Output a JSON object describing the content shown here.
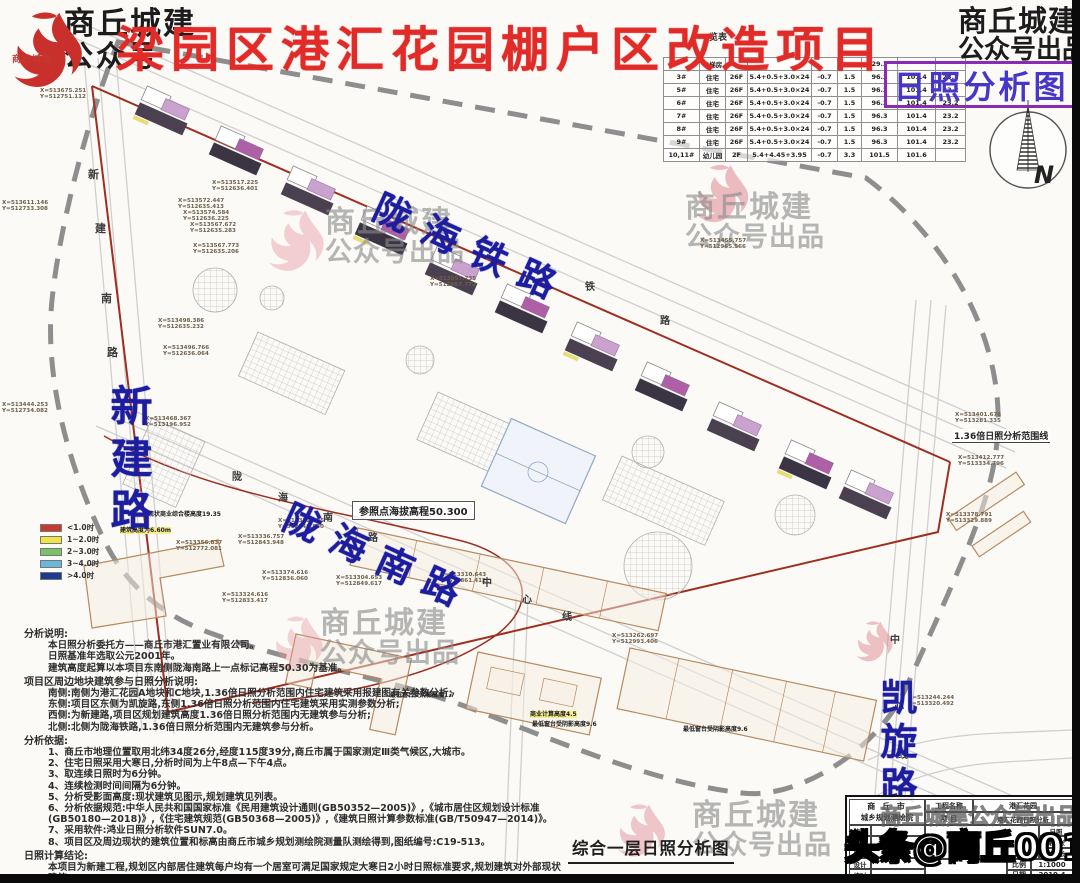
{
  "branding": {
    "top_left": {
      "line1": "商丘城建",
      "line2": "公众号",
      "seal_text": "商丘城建"
    },
    "top_right": {
      "line1": "商丘城建",
      "line2": "公众号出品"
    },
    "watermark": {
      "line1": "商丘城建",
      "line2": "公众号出品"
    },
    "watermark_full": "商丘城建公众号出品",
    "bottom_overlay": "头条@商丘001"
  },
  "header": {
    "title": "梁园区港汇花园棚户区改造项目",
    "subtitle": "日照分析图",
    "title_color": "#e12b28",
    "subtitle_color": "#4637c9",
    "subtitle_border_color": "#8a2bb5"
  },
  "building_table": {
    "title_fragment": "一览表",
    "header_visible": [
      "",
      "电梯房",
      "",
      "",
      "",
      "",
      "29.3",
      "",
      ""
    ],
    "rows": [
      [
        "3#",
        "住宅",
        "26F",
        "5.4+0.5+3.0×24",
        "-0.7",
        "1.5",
        "96.3",
        "101.4",
        "23.2"
      ],
      [
        "5#",
        "住宅",
        "26F",
        "5.4+0.5+3.0×24",
        "-0.7",
        "1.5",
        "96.3",
        "101.4",
        "23.2"
      ],
      [
        "6#",
        "住宅",
        "26F",
        "5.4+0.5+3.0×24",
        "-0.7",
        "1.5",
        "96.3",
        "101.4",
        "23.2"
      ],
      [
        "7#",
        "住宅",
        "26F",
        "5.4+0.5+3.0×24",
        "-0.7",
        "1.5",
        "96.3",
        "101.4",
        "23.2"
      ],
      [
        "8#",
        "住宅",
        "26F",
        "5.4+0.5+3.0×24",
        "-0.7",
        "1.5",
        "96.3",
        "101.4",
        "23.2"
      ],
      [
        "9#",
        "住宅",
        "26F",
        "5.4+0.5+3.0×24",
        "-0.7",
        "1.5",
        "96.3",
        "101.4",
        "23.2"
      ],
      [
        "10,11#",
        "幼儿园",
        "2F",
        "5.4+4.45+3.95",
        "-0.7",
        "3.3",
        "101.5",
        "101.6",
        ""
      ]
    ]
  },
  "legend": {
    "items": [
      {
        "color": "#c43b30",
        "label": "<1.0时"
      },
      {
        "color": "#efe34a",
        "label": "1~2.0时"
      },
      {
        "color": "#7cc06a",
        "label": "2~3.0时"
      },
      {
        "color": "#69b7d9",
        "label": "3~4.0时"
      },
      {
        "color": "#1d3c8f",
        "label": ">4.0时"
      }
    ]
  },
  "map": {
    "north": "N",
    "labels": {
      "railway": "陇海铁路",
      "south_road": "陇海南路",
      "west_road": "新建路",
      "east_road": "凯旋路",
      "reference": "参照点海拔高程50.300",
      "range": "1.36倍日照分析范围线"
    },
    "road_chars": [
      {
        "ch": "新",
        "x": 88,
        "y": 166,
        "s": 11
      },
      {
        "ch": "建",
        "x": 95,
        "y": 220,
        "s": 11
      },
      {
        "ch": "南",
        "x": 101,
        "y": 290,
        "s": 11
      },
      {
        "ch": "路",
        "x": 107,
        "y": 344,
        "s": 11
      },
      {
        "ch": "陇",
        "x": 232,
        "y": 468,
        "s": 10
      },
      {
        "ch": "海",
        "x": 278,
        "y": 489,
        "s": 10
      },
      {
        "ch": "南",
        "x": 323,
        "y": 509,
        "s": 10
      },
      {
        "ch": "路",
        "x": 368,
        "y": 529,
        "s": 10
      },
      {
        "ch": "中",
        "x": 482,
        "y": 574,
        "s": 10
      },
      {
        "ch": "心",
        "x": 522,
        "y": 591,
        "s": 10
      },
      {
        "ch": "线",
        "x": 562,
        "y": 608,
        "s": 10
      },
      {
        "ch": "铁",
        "x": 585,
        "y": 278,
        "s": 10
      },
      {
        "ch": "路",
        "x": 660,
        "y": 312,
        "s": 10
      },
      {
        "ch": "中",
        "x": 890,
        "y": 631,
        "s": 10
      },
      {
        "ch": "心",
        "x": 894,
        "y": 698,
        "s": 10
      },
      {
        "ch": "线",
        "x": 898,
        "y": 746,
        "s": 10
      }
    ],
    "coord_labels": [
      {
        "x": 40,
        "y": 88,
        "a": "X=513675.251",
        "b": "Y=512751.112"
      },
      {
        "x": 2,
        "y": 200,
        "a": "X=513611.146",
        "b": "Y=512733.308"
      },
      {
        "x": 2,
        "y": 402,
        "a": "X=513444.253",
        "b": "Y=512734.082"
      },
      {
        "x": 212,
        "y": 180,
        "a": "X=513517.225",
        "b": "Y=512636.401"
      },
      {
        "x": 178,
        "y": 198,
        "a": "X=513572.447",
        "b": "Y=512635.413"
      },
      {
        "x": 183,
        "y": 210,
        "a": "X=513574.584",
        "b": "Y=512636.225"
      },
      {
        "x": 190,
        "y": 222,
        "a": "X=513567.672",
        "b": "Y=512635.283"
      },
      {
        "x": 193,
        "y": 243,
        "a": "X=513567.773",
        "b": "Y=512635.206"
      },
      {
        "x": 158,
        "y": 318,
        "a": "X=513498.386",
        "b": "Y=512635.232"
      },
      {
        "x": 163,
        "y": 345,
        "a": "X=513496.766",
        "b": "Y=512636.064"
      },
      {
        "x": 145,
        "y": 416,
        "a": "X=513468.367",
        "b": "Y=513196.952"
      },
      {
        "x": 278,
        "y": 518,
        "a": "X=513372.225",
        "b": "Y=512849.880"
      },
      {
        "x": 176,
        "y": 540,
        "a": "X=513356.837",
        "b": "Y=512772.081"
      },
      {
        "x": 238,
        "y": 534,
        "a": "X=513336.757",
        "b": "Y=512843.948"
      },
      {
        "x": 262,
        "y": 570,
        "a": "X=513374.616",
        "b": "Y=512836.060"
      },
      {
        "x": 222,
        "y": 592,
        "a": "X=513324.616",
        "b": "Y=512833.417"
      },
      {
        "x": 336,
        "y": 575,
        "a": "X=513304.653",
        "b": "Y=512849.617"
      },
      {
        "x": 440,
        "y": 572,
        "a": "X=513310.643",
        "b": "Y=512861.412"
      },
      {
        "x": 430,
        "y": 276,
        "a": "X=513057.735",
        "b": "Y=512967.772"
      },
      {
        "x": 700,
        "y": 238,
        "a": "X=513455.757",
        "b": "Y=512965.566"
      },
      {
        "x": 955,
        "y": 412,
        "a": "X=513401.676",
        "b": "Y=513281.335"
      },
      {
        "x": 958,
        "y": 455,
        "a": "X=513412.777",
        "b": "Y=513334.796"
      },
      {
        "x": 946,
        "y": 512,
        "a": "X=513378.791",
        "b": "Y=513329.889"
      },
      {
        "x": 908,
        "y": 695,
        "a": "X=513244.244",
        "b": "Y=513320.492"
      },
      {
        "x": 612,
        "y": 633,
        "a": "X=513262.697",
        "b": "Y=512993.406"
      }
    ],
    "annotations": [
      {
        "x": 120,
        "y": 527,
        "t": "建筑高度为6.60m",
        "hl": 1
      },
      {
        "x": 148,
        "y": 511,
        "t": "现状商业综合楼高度19.35",
        "hl": 0
      },
      {
        "x": 390,
        "y": 692,
        "t": "最低窗台受阴影高度1.7",
        "hl": 0
      },
      {
        "x": 530,
        "y": 711,
        "t": "商业计算高度4.5",
        "hl": 1
      },
      {
        "x": 532,
        "y": 721,
        "t": "最低窗台受阴影高度9.6",
        "hl": 0
      },
      {
        "x": 683,
        "y": 726,
        "t": "最低窗台受阴影高度9.6",
        "hl": 0
      }
    ],
    "watermarks": [
      {
        "x": 395,
        "y": 237
      },
      {
        "x": 755,
        "y": 222
      },
      {
        "x": 390,
        "y": 638
      },
      {
        "x": 762,
        "y": 830
      }
    ]
  },
  "notes": {
    "sections": [
      {
        "heading": "分析说明:",
        "lines": [
          "本日照分析委托方——商丘市港汇置业有限公司。",
          "日照基准年选取公元2001年。",
          "建筑高度起算以本项目东南侧陇海南路上一点标记高程50.30为基准。"
        ]
      },
      {
        "heading": "项目区周边地块建筑参与日照分析说明:",
        "lines": [
          "南侧:南侧为港汇花园A地块和C地块,1.36倍日照分析范围内住宅建筑采用报建图有关参数分析;",
          "东侧:项目区东侧为凯旋路,东侧1.36倍日照分析范围内住宅建筑采用实测参数分析;",
          "西侧:为新建路,项目区规划建筑高度1.36倍日照分析范围内无建筑参与分析;",
          "北侧:北侧为陇海铁路,1.36倍日照分析范围内无建筑参与分析。"
        ]
      },
      {
        "heading": "分析依据:",
        "lines": [
          "1、商丘市地理位置取用北纬34度26分,经度115度39分,商丘市属于国家测定Ⅲ类气候区,大城市。",
          "2、住宅日照采用大寒日,分析时间为上午8点—下午4点。",
          "3、取连续日照时为6分钟。",
          "4、连续检测时间间隔为6分钟。",
          "5、分析受影面高度:现状建筑见图示,规划建筑见列表。",
          "6、分析依据规范:中华人民共和国国家标准《民用建筑设计通则(GB50352—2005)》,《城市居住区规划设计标准(GB50180—2018)》,《住宅建筑规范(GB50368—2005)》,《建筑日照计算参数标准(GB/T50947—2014)》。",
          "7、采用软件:鸿业日照分析软件SUN7.0。",
          "8、项目区及周边现状的建筑位置和标高由商丘市城乡规划测绘院测量队测绘得到,图纸编号:C19-513。"
        ]
      },
      {
        "heading": "日照计算结论:",
        "lines": [
          "本项目为新建工程,规划区内部居住建筑每户均有一个居室可满足国家规定大寒日2小时日照标准要求,规划建筑对外部现状建筑"
        ]
      }
    ]
  },
  "footer": {
    "drawing_title": "综合一层日照分析图",
    "titleblock": {
      "inst1": "商 丘 市",
      "inst2": "城乡规划测绘院",
      "sig_labels": [
        "院长",
        "审定",
        "审核",
        "设计",
        "校对"
      ],
      "pname_label": "工程名称",
      "pname": "港汇花园",
      "item_label": "项 目",
      "item": "港汇花园日照分析",
      "side_cells": [
        "日照",
        "第1张",
        "共1张"
      ],
      "scale_label": "比例",
      "scale": "1:1000",
      "date_label": "日期",
      "date": "2019.4"
    }
  }
}
